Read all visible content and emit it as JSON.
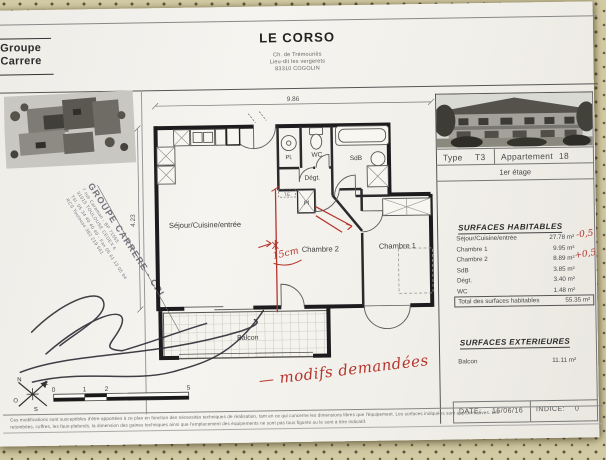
{
  "header": {
    "logo_line1": "Groupe",
    "logo_line2": "Carrere",
    "project": "LE CORSO",
    "address1": "Ch. de Trémouriès",
    "address2": "Lieu-dit les vergerets",
    "address3": "83310 COGOLIN"
  },
  "title_block": {
    "type_label": "Type",
    "type_value": "T3",
    "apartment_label": "Appartement",
    "apartment_value": "18",
    "floor": "1er étage"
  },
  "surfaces_habitables": {
    "heading": "SURFACES HABITABLES",
    "rows": [
      {
        "label": "Séjour/Cuisine/entrée",
        "value": "27.78 m²"
      },
      {
        "label": "Chambre 1",
        "value": "9.95 m²"
      },
      {
        "label": "Chambre 2",
        "value": "8.89 m²"
      },
      {
        "label": "SdB",
        "value": "3.85 m²"
      },
      {
        "label": "Dégt.",
        "value": "3.40 m²"
      },
      {
        "label": "WC",
        "value": "1.48 m²"
      }
    ],
    "total_label": "Total des surfaces habitables",
    "total_value": "55.35 m²"
  },
  "surfaces_exterieures": {
    "heading": "SURFACES EXTERIEURES",
    "rows": [
      {
        "label": "Balcon",
        "value": "11.11 m²"
      }
    ]
  },
  "footer": {
    "date_label": "DATE:",
    "date_value": "16/06/16",
    "indice_label": "INDICE:",
    "indice_value": "0"
  },
  "disclaimer": {
    "line1": "Ces modifications sont susceptibles d'être apportées à ce plan en fonction des nécessités techniques de réalisation, tant en ce qui concerne les dimensions libres que l'équipement. Les surfaces indiquées sont approximatives. Les",
    "line2": "retombées, coffres, les faux-plafonds, la dimension des gaines techniques ainsi que l'emplacement des équipements ne sont pas tous figurés ou le sont à titre indicatif."
  },
  "plan": {
    "dimension_top": "9.86",
    "dimension_left": "4.23",
    "rooms": {
      "sejour": "Séjour/Cuisine/entrée",
      "chambre2": "Chambre 2",
      "chambre1": "Chambre 1",
      "balcon": "Balcon",
      "wc": "WC",
      "sdb": "SdB",
      "degt": "Dégt.",
      "pl1": "Pl.",
      "pl2": "Pl",
      "te": "T.E"
    },
    "scale_labels": [
      "0",
      "1",
      "2",
      "5"
    ],
    "compass": {
      "n": "N",
      "e": "E",
      "s": "S",
      "o": "O"
    }
  },
  "annotations": {
    "offset_note": "15cm",
    "request_note": "— modifs demandées",
    "sejour_delta": "-0,5",
    "chambre2_delta": "+0,5",
    "accent_color": "#b5342c"
  },
  "stamp": {
    "line1": "GROUPE CARRERE - CPI",
    "line2": "7 rue Caraman - BP 71555",
    "line3": "31015 TOULOUSE CEDEX 6",
    "line4": "Tél. 05 34 40 40 40 - Fax 05 61 13 05 04",
    "line5": "RCS Toulouse 382 219 561"
  }
}
